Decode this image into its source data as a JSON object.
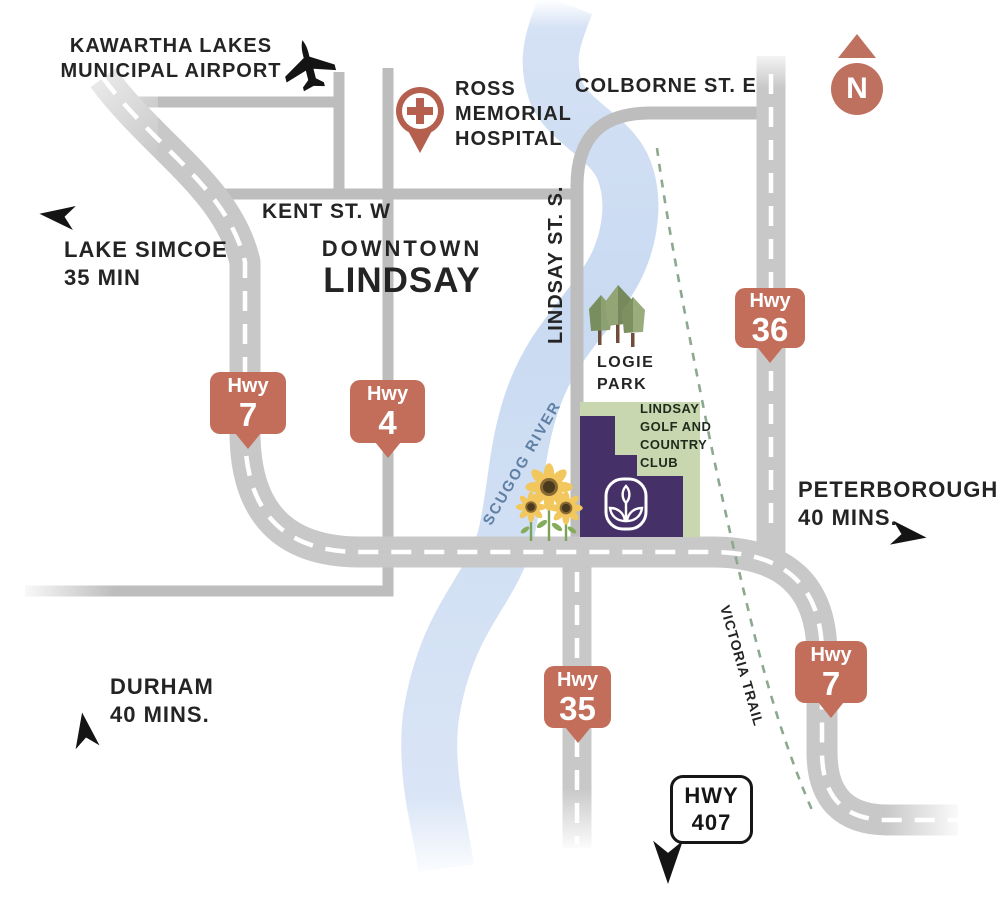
{
  "labels": {
    "airport": {
      "line1": "KAWARTHA LAKES",
      "line2": "MUNICIPAL AIRPORT"
    },
    "hospital": {
      "line1": "ROSS",
      "line2": "MEMORIAL",
      "line3": "HOSPITAL"
    },
    "colborne": "COLBORNE ST. E",
    "kent": "KENT ST. W",
    "downtown": {
      "line1": "DOWNTOWN",
      "line2": "LINDSAY"
    },
    "lake_simcoe": {
      "line1": "LAKE SIMCOE",
      "line2": "35 MIN"
    },
    "lindsay_st": "LINDSAY ST. S.",
    "scugog_river": "SCUGOG RIVER",
    "logie_park": {
      "line1": "LOGIE",
      "line2": "PARK"
    },
    "golf_club": {
      "line1": "LINDSAY",
      "line2": "GOLF AND",
      "line3": "COUNTRY",
      "line4": "CLUB"
    },
    "peterborough": {
      "line1": "PETERBOROUGH",
      "line2": "40 MINS."
    },
    "durham": {
      "line1": "DURHAM",
      "line2": "40 MINS."
    },
    "victoria_trail": "VICTORIA TRAIL",
    "compass": "N"
  },
  "shields": [
    {
      "id": "hwy-7-west",
      "label": "Hwy",
      "number": "7"
    },
    {
      "id": "hwy-4",
      "label": "Hwy",
      "number": "4"
    },
    {
      "id": "hwy-36",
      "label": "Hwy",
      "number": "36"
    },
    {
      "id": "hwy-35",
      "label": "Hwy",
      "number": "35"
    },
    {
      "id": "hwy-7-southeast",
      "label": "Hwy",
      "number": "7"
    }
  ],
  "badge_hwy407": {
    "line1": "HWY",
    "line2": "407"
  },
  "icons": {
    "airplane": "airplane-silhouette",
    "hospital_pin": "medical-cross-pin",
    "north_compass": "north-arrow-circle",
    "site_logo": "seed-sprout-badge",
    "park_trees": "three-trees",
    "sunflowers": "three-sunflowers",
    "direction_arrows": "concave-arrowheads"
  },
  "colors": {
    "road_major": "#c8c8c8",
    "road_minor": "#bdbdbd",
    "river": "#cddcf2",
    "trail_green": "#8ca88e",
    "shield_terracotta": "#c36e5a",
    "compass_terracotta": "#bf7160",
    "hospital_pin": "#b5604e",
    "site_purple": "#453168",
    "golf_green": "#c9d7b0",
    "text": "#242424",
    "river_label": "#5f7fa4"
  }
}
